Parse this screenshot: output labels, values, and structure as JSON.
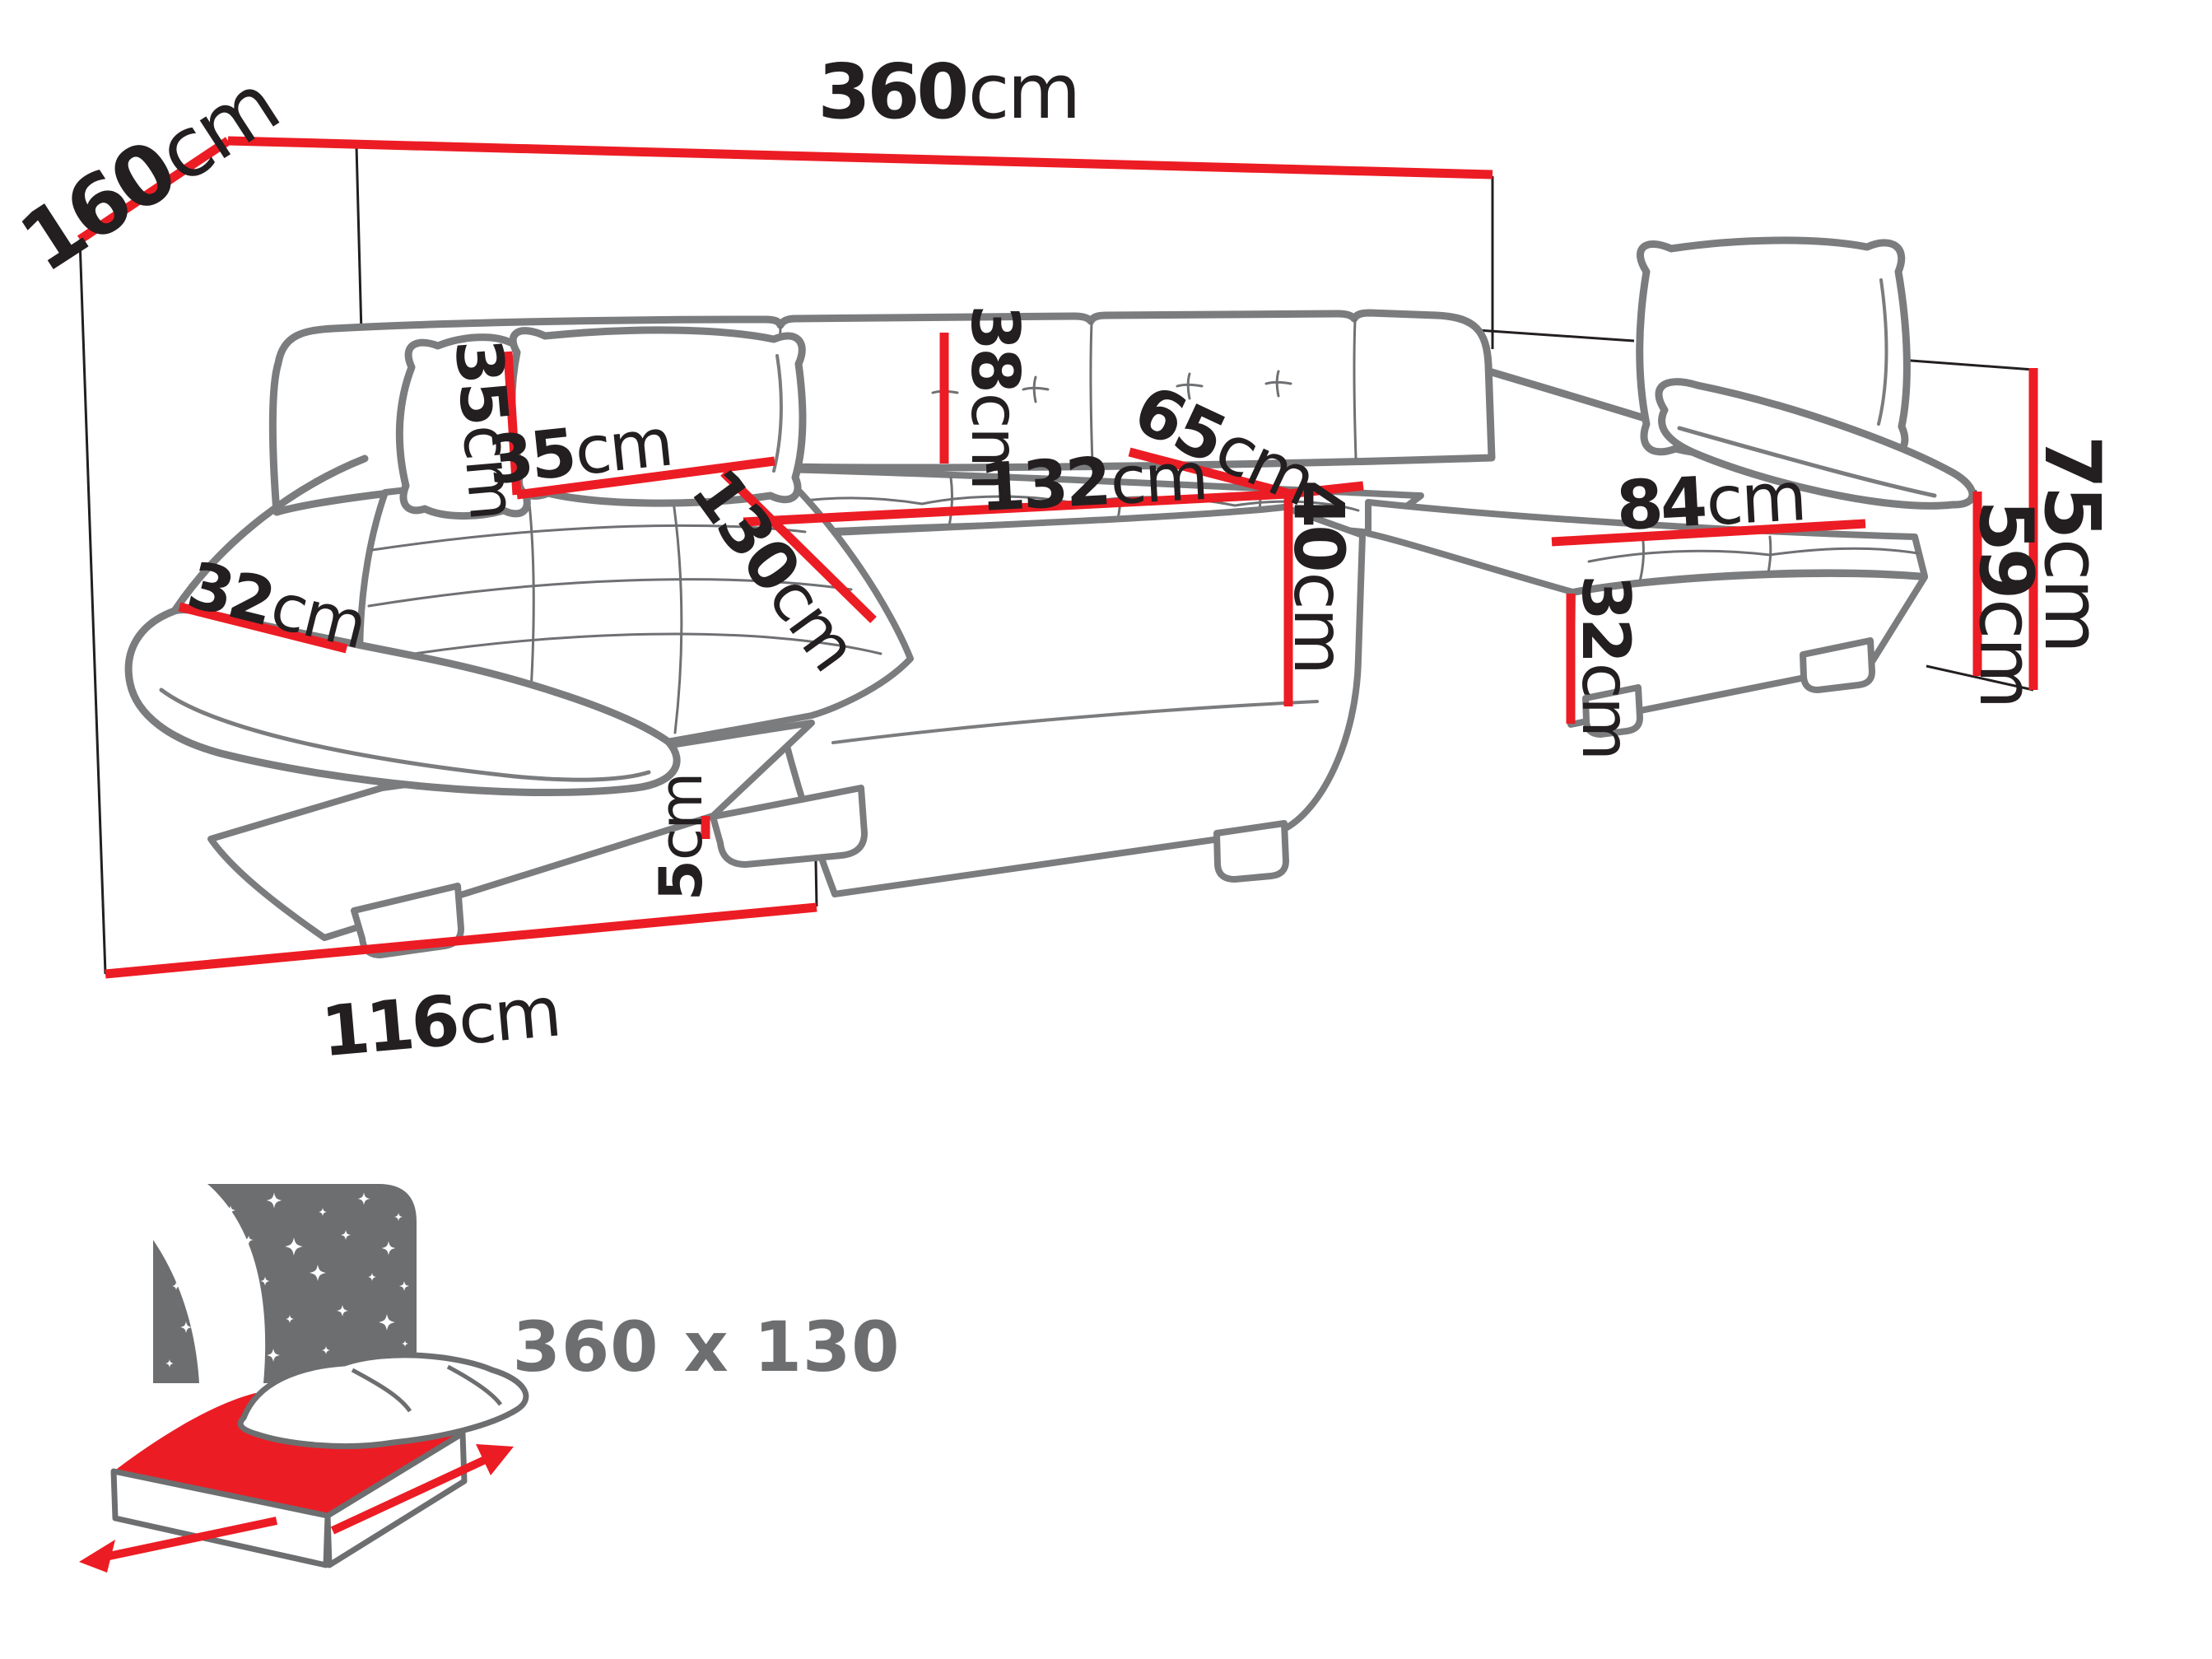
{
  "diagram": {
    "type": "corner-sofa-dimension-diagram",
    "colors": {
      "dimension_red": "#ec1c24",
      "sofa_outline_gray": "#7b7c7e",
      "projection_line_black": "#231f20",
      "text_black": "#231f20",
      "icon_gray": "#6d6e70"
    },
    "dims": {
      "total_width": {
        "value": "360",
        "unit": "cm"
      },
      "side_depth": {
        "value": "160",
        "unit": "cm"
      },
      "total_height": {
        "value": "75",
        "unit": "cm"
      },
      "armrest_height": {
        "value": "59",
        "unit": "cm"
      },
      "right_seat_width": {
        "value": "84",
        "unit": "cm"
      },
      "right_base_height": {
        "value": "32",
        "unit": "cm"
      },
      "middle_seat_depth": {
        "value": "65",
        "unit": "cm"
      },
      "middle_seat_width": {
        "value": "132",
        "unit": "cm"
      },
      "seat_height": {
        "value": "40",
        "unit": "cm"
      },
      "backrest_height": {
        "value": "38",
        "unit": "cm"
      },
      "pillow_height": {
        "value": "35",
        "unit": "cm"
      },
      "pillow_width": {
        "value": "35",
        "unit": "cm"
      },
      "chaise_length": {
        "value": "130",
        "unit": "cm"
      },
      "armrest_width": {
        "value": "32",
        "unit": "cm"
      },
      "leg_height": {
        "value": "5",
        "unit": "cm"
      },
      "chaise_width": {
        "value": "116",
        "unit": "cm"
      }
    },
    "sleeping_function": {
      "icon": "sleeping-bed-icon",
      "bed_size": "360 x 130"
    }
  }
}
